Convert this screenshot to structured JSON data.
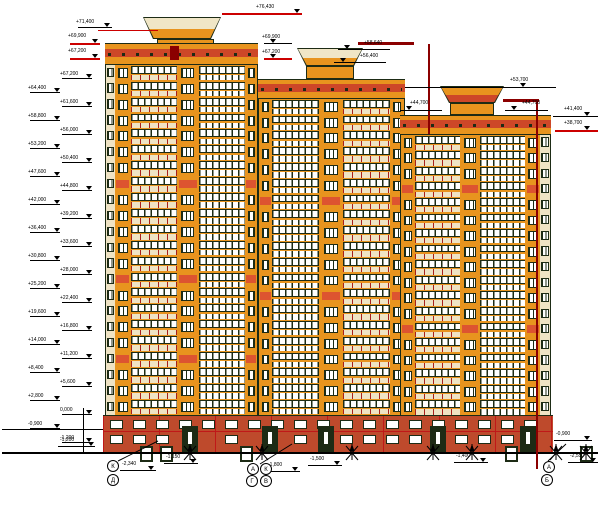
{
  "colors": {
    "orange": "#E8941E",
    "red_stripe": "#CD4728",
    "accent": "#DD5430",
    "maroon": "#8B0000",
    "frame": "#1D2B15",
    "cream": "#EFE3C4",
    "brick": "#BE4A2C",
    "brick_line": "#C01818",
    "annotation_red": "#CC0000",
    "white": "#FFFFFF",
    "bg": "#FFFFFF"
  },
  "drawing": {
    "canvas": {
      "w": 602,
      "h": 505
    },
    "towers": [
      {
        "id": "tower-1",
        "x": 105,
        "w": 153,
        "floors": 22,
        "body_y": 65,
        "cap": {
          "cx": 182,
          "wt": 78,
          "wb": 58,
          "y": 17,
          "h": 22,
          "top": "#F0E6C6",
          "bot": "#E8941E"
        },
        "machine": {
          "x": 157,
          "y": 39,
          "w": 57,
          "h": 14
        },
        "parapet": {
          "y": 43,
          "h": 22
        },
        "accents": [
          7,
          13,
          18
        ],
        "columns": [
          {
            "t": "edge",
            "w": 9
          },
          {
            "t": "pier",
            "w": 16
          },
          {
            "t": "bay",
            "w": 47,
            "v": "cream"
          },
          {
            "t": "pier",
            "w": 22
          },
          {
            "t": "bay",
            "w": 47,
            "v": "white"
          },
          {
            "t": "pier",
            "w": 12
          }
        ]
      },
      {
        "id": "tower-2",
        "x": 258,
        "w": 147,
        "floors": 20,
        "body_y": 99,
        "cap": {
          "cx": 330,
          "wt": 66,
          "wb": 48,
          "y": 48,
          "h": 18,
          "top": "#F0E6C6",
          "bot": "#E8941E"
        },
        "machine": {
          "x": 306,
          "y": 66,
          "w": 48,
          "h": 13
        },
        "parapet": {
          "y": 79,
          "h": 20
        },
        "accents": [
          6,
          12
        ],
        "columns": [
          {
            "t": "pier",
            "w": 13
          },
          {
            "t": "bay",
            "w": 48,
            "v": "white"
          },
          {
            "t": "pier",
            "w": 24
          },
          {
            "t": "bay",
            "w": 48,
            "v": "cream"
          },
          {
            "t": "pier",
            "w": 14
          }
        ]
      },
      {
        "id": "tower-3",
        "x": 400,
        "w": 151,
        "floors": 18,
        "body_y": 135,
        "cap": {
          "cx": 472,
          "wt": 64,
          "wb": 46,
          "y": 86,
          "h": 17,
          "top": "#E8941E",
          "bot": "#CD4728"
        },
        "machine": {
          "x": 450,
          "y": 103,
          "w": 44,
          "h": 12
        },
        "parapet": {
          "y": 115,
          "h": 20
        },
        "accents": [
          3,
          12
        ],
        "columns": [
          {
            "t": "pier",
            "w": 14
          },
          {
            "t": "bay",
            "w": 46,
            "v": "cream"
          },
          {
            "t": "pier",
            "w": 20
          },
          {
            "t": "bay",
            "w": 46,
            "v": "white"
          },
          {
            "t": "pier",
            "w": 15
          },
          {
            "t": "edge",
            "w": 10
          }
        ]
      }
    ],
    "base": {
      "x": 103,
      "y": 415,
      "w": 450,
      "h": 38,
      "doors": [
        182,
        262,
        318,
        430,
        520
      ],
      "wells": [
        140,
        160,
        240,
        505,
        580
      ],
      "win_rows": [
        4,
        19
      ]
    },
    "left_marks": [
      {
        "col": "inner",
        "y": 78,
        "label": "+67,200"
      },
      {
        "col": "outer",
        "y": 92,
        "label": "+64,400"
      },
      {
        "col": "inner",
        "y": 106,
        "label": "+61,600"
      },
      {
        "col": "outer",
        "y": 120,
        "label": "+58,800"
      },
      {
        "col": "inner",
        "y": 134,
        "label": "+56,000"
      },
      {
        "col": "outer",
        "y": 148,
        "label": "+53,200"
      },
      {
        "col": "inner",
        "y": 162,
        "label": "+50,400"
      },
      {
        "col": "outer",
        "y": 176,
        "label": "+47,600"
      },
      {
        "col": "inner",
        "y": 190,
        "label": "+44,800"
      },
      {
        "col": "outer",
        "y": 204,
        "label": "+42,000"
      },
      {
        "col": "inner",
        "y": 218,
        "label": "+39,200"
      },
      {
        "col": "outer",
        "y": 232,
        "label": "+36,400"
      },
      {
        "col": "inner",
        "y": 246,
        "label": "+33,600"
      },
      {
        "col": "outer",
        "y": 260,
        "label": "+30,800"
      },
      {
        "col": "inner",
        "y": 274,
        "label": "+28,000"
      },
      {
        "col": "outer",
        "y": 288,
        "label": "+25,200"
      },
      {
        "col": "inner",
        "y": 302,
        "label": "+22,400"
      },
      {
        "col": "outer",
        "y": 316,
        "label": "+19,600"
      },
      {
        "col": "inner",
        "y": 330,
        "label": "+16,800"
      },
      {
        "col": "outer",
        "y": 344,
        "label": "+14,000"
      },
      {
        "col": "inner",
        "y": 358,
        "label": "+11,200"
      },
      {
        "col": "outer",
        "y": 372,
        "label": "+8,400"
      },
      {
        "col": "inner",
        "y": 386,
        "label": "+5,600"
      },
      {
        "col": "outer",
        "y": 400,
        "label": "+2,800"
      },
      {
        "col": "inner",
        "y": 414,
        "label": "0,000"
      },
      {
        "col": "outer",
        "y": 428,
        "label": "-0,900"
      },
      {
        "col": "inner",
        "y": 442,
        "label": "-1,200"
      }
    ],
    "top_marks": [
      {
        "label": "+76,430",
        "x": 256,
        "y": 5,
        "lx1": 222,
        "lx2": 302,
        "ly": 13,
        "lc": "#CC0000",
        "tx": 294
      },
      {
        "label": "+71,400",
        "x": 76,
        "y": 20,
        "lx1": 78,
        "lx2": 112,
        "ly": 27,
        "lc": "#000000",
        "tx": 104
      },
      {
        "label": "+69,900",
        "x": 68,
        "y": 34,
        "lx1": 70,
        "lx2": 100,
        "ly": 43,
        "lc": "#CC0000",
        "tx": 92
      },
      {
        "label": "+67,200",
        "x": 68,
        "y": 49,
        "lx1": 70,
        "lx2": 100,
        "ly": 58,
        "lc": "#CC0000",
        "tx": 92
      },
      {
        "label": "+69,900",
        "x": 262,
        "y": 35,
        "lx1": 264,
        "lx2": 292,
        "ly": 43,
        "lc": "#000000",
        "tx": 270
      },
      {
        "label": "+67,200",
        "x": 262,
        "y": 50,
        "lx1": 264,
        "lx2": 292,
        "ly": 58,
        "lc": "#CC0000",
        "tx": 270
      },
      {
        "label": "+58,640",
        "x": 364,
        "y": 41,
        "lx1": 338,
        "lx2": 390,
        "ly": 49,
        "lc": "#000000",
        "tx": 344
      },
      {
        "label": "+56,400",
        "x": 360,
        "y": 54,
        "lx1": 334,
        "lx2": 386,
        "ly": 62,
        "lc": "#000000",
        "tx": 340
      },
      {
        "label": "+53,700",
        "x": 510,
        "y": 78,
        "lx1": 405,
        "lx2": 556,
        "ly": 87,
        "lc": "#000000",
        "tx": 520
      },
      {
        "label": "+44,700",
        "x": 410,
        "y": 101,
        "lx1": 400,
        "lx2": 442,
        "ly": 110,
        "lc": "#000000",
        "tx": 406
      },
      {
        "label": "+44,700",
        "x": 522,
        "y": 101,
        "lx1": 505,
        "lx2": 548,
        "ly": 110,
        "lc": "#000000",
        "tx": 511
      },
      {
        "label": "+41,400",
        "x": 564,
        "y": 107,
        "lx1": 553,
        "lx2": 598,
        "ly": 116,
        "lc": "#000000",
        "tx": 584
      },
      {
        "label": "+38,700",
        "x": 564,
        "y": 121,
        "lx1": 555,
        "lx2": 598,
        "ly": 130,
        "lc": "#CC0000",
        "tx": 584
      }
    ],
    "ground_marks": [
      {
        "label": "-1,200",
        "x": 60,
        "y": 438,
        "lx1": 58,
        "lx2": 95,
        "ly": 446,
        "lc": "#000000",
        "tx": 88
      },
      {
        "label": "-2,340",
        "x": 122,
        "y": 462,
        "lx1": 120,
        "lx2": 156,
        "ly": 470,
        "lc": "#000000",
        "tx": 148
      },
      {
        "label": "-1,150",
        "x": 166,
        "y": 455,
        "lx1": 164,
        "lx2": 198,
        "ly": 463,
        "lc": "#000000",
        "tx": 190
      },
      {
        "label": "-1,800",
        "x": 268,
        "y": 463,
        "lx1": 266,
        "lx2": 300,
        "ly": 471,
        "lc": "#000000",
        "tx": 292
      },
      {
        "label": "-1,500",
        "x": 310,
        "y": 457,
        "lx1": 308,
        "lx2": 342,
        "ly": 465,
        "lc": "#000000",
        "tx": 334
      },
      {
        "label": "-1,400",
        "x": 456,
        "y": 454,
        "lx1": 454,
        "lx2": 488,
        "ly": 462,
        "lc": "#000000",
        "tx": 480
      },
      {
        "label": "-0,900",
        "x": 556,
        "y": 432,
        "lx1": 554,
        "lx2": 592,
        "ly": 440,
        "lc": "#000000",
        "tx": 584
      },
      {
        "label": "-2,550",
        "x": 570,
        "y": 454,
        "lx1": 568,
        "lx2": 598,
        "ly": 462,
        "lc": "#000000",
        "tx": 590
      }
    ],
    "axis_circles": [
      {
        "x": 113,
        "y": 466,
        "label": "К"
      },
      {
        "x": 113,
        "y": 480,
        "label": "Д"
      },
      {
        "x": 253,
        "y": 469,
        "label": "А"
      },
      {
        "x": 266,
        "y": 469,
        "label": "К"
      },
      {
        "x": 252,
        "y": 481,
        "label": "Г"
      },
      {
        "x": 266,
        "y": 481,
        "label": "В"
      },
      {
        "x": 549,
        "y": 467,
        "label": "А"
      },
      {
        "x": 547,
        "y": 480,
        "label": "Б"
      }
    ],
    "lines": [
      {
        "x": 2,
        "y": 452,
        "w": 596,
        "h": 2,
        "c": "#000000",
        "n": "ground-line"
      },
      {
        "x": 2,
        "y": 429,
        "w": 101,
        "h": 1,
        "c": "#000000",
        "n": "grade-line-left"
      },
      {
        "x": 83,
        "y": 408,
        "w": 1,
        "h": 45,
        "c": "#000000",
        "n": "leader-vertical-left"
      },
      {
        "x": 98,
        "y": 30,
        "w": 60,
        "h": 1,
        "c": "#CC0000",
        "n": "red-leader-tower1-left"
      },
      {
        "x": 358,
        "y": 42,
        "w": 56,
        "h": 3,
        "c": "#8B0000",
        "n": "lightning-conductor-t2-h"
      },
      {
        "x": 428,
        "y": 44,
        "w": 2,
        "h": 90,
        "c": "#8B0000",
        "n": "lightning-conductor-t2-v"
      },
      {
        "x": 503,
        "y": 99,
        "w": 36,
        "h": 3,
        "c": "#8B0000",
        "n": "lightning-conductor-t3-h"
      },
      {
        "x": 536,
        "y": 101,
        "w": 2,
        "h": 368,
        "c": "#8B0000",
        "n": "lightning-conductor-t3-v"
      },
      {
        "x": 170,
        "y": 46,
        "w": 9,
        "h": 14,
        "c": "#8B0000",
        "n": "lightning-conductor-t1-block"
      }
    ],
    "arrows": {
      "xs": [
        190,
        262,
        352,
        433,
        472,
        556,
        586
      ],
      "y": 460
    },
    "leaders": [
      {
        "x1": 118,
        "y1": 461,
        "x2": 158,
        "y2": 441
      },
      {
        "x1": 260,
        "y1": 464,
        "x2": 292,
        "y2": 444
      },
      {
        "x1": 548,
        "y1": 461,
        "x2": 566,
        "y2": 444
      }
    ]
  }
}
